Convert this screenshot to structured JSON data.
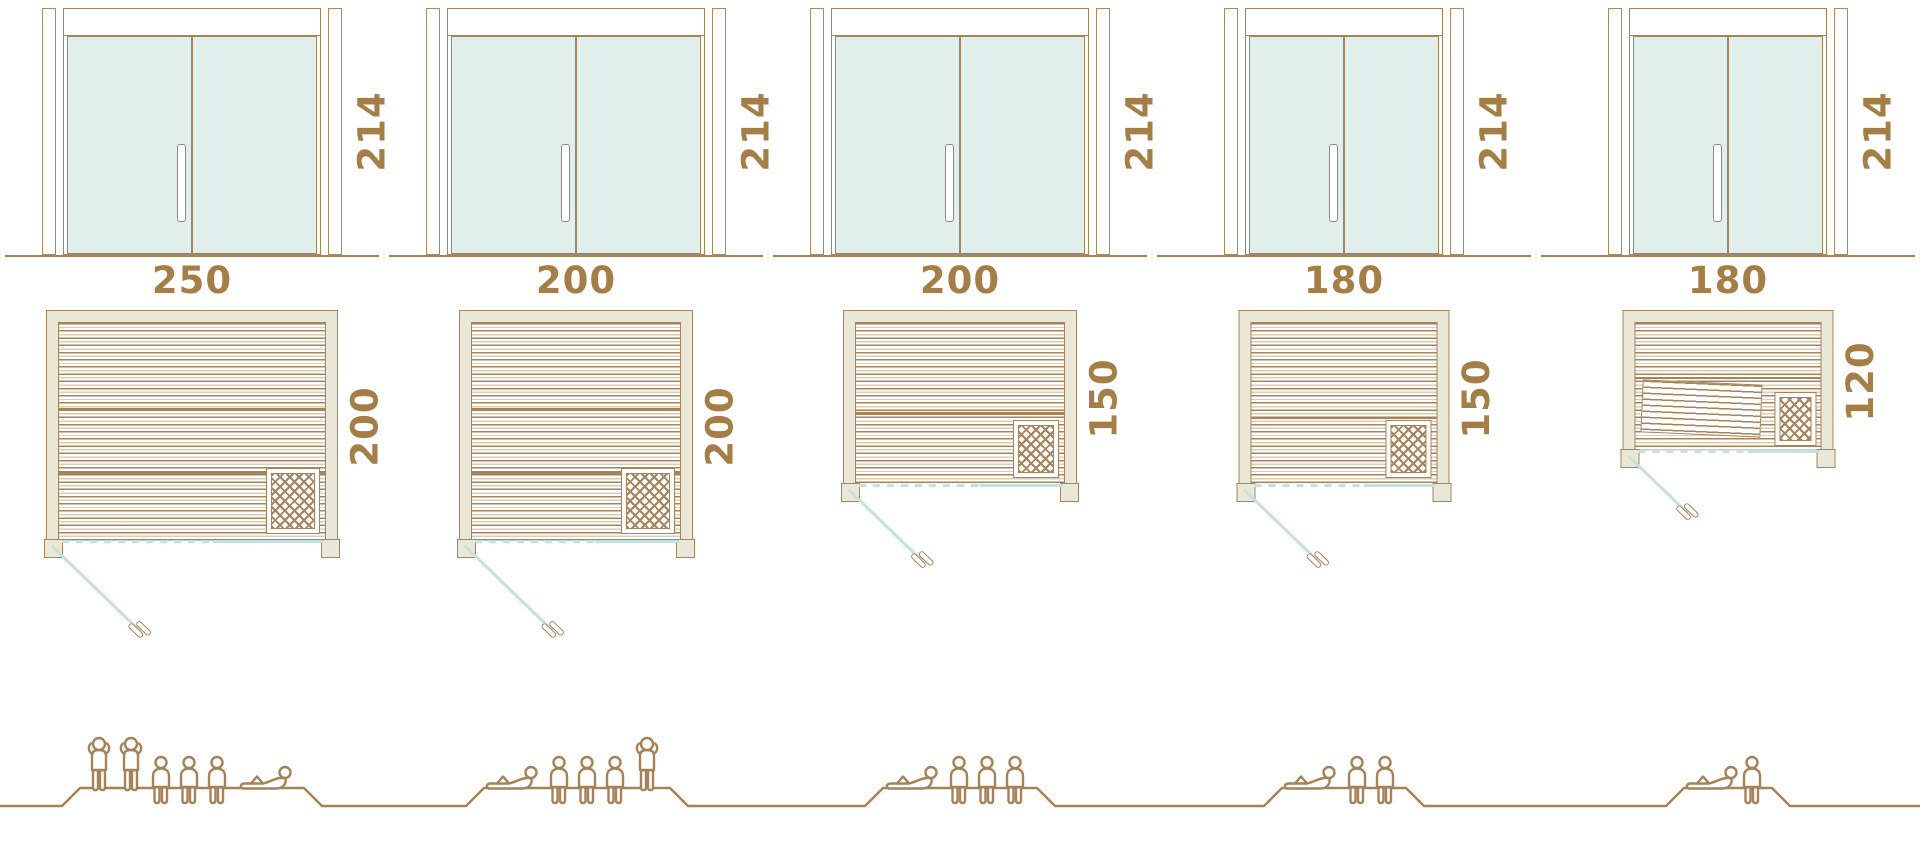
{
  "diagram_title": "sauna sizes with door elevation, floor plan and capacity figures",
  "colors": {
    "line_brown": "#a6835b",
    "figure_brown": "#a58257",
    "dimension_text": "#a57d46",
    "wall_beige": "#ebe7d6",
    "glass_mint": "#e1efec",
    "glass_front_blue": "#c6e0dc",
    "background": "#ffffff"
  },
  "icons": {
    "standing_icon": "person-standing",
    "seated_icon": "person-seated",
    "lying_icon": "person-lying",
    "heater_icon": "sauna-heater-lattice",
    "handle_icon": "door-handle"
  },
  "units": [
    {
      "door_height": "214",
      "plan_width": "250",
      "plan_depth": "200",
      "capacity": {
        "standing": 2,
        "seated": 3,
        "lying": 1,
        "total": 6,
        "figure_sequence": [
          "standing",
          "standing",
          "seated",
          "seated",
          "seated",
          "lying"
        ]
      }
    },
    {
      "door_height": "214",
      "plan_width": "200",
      "plan_depth": "200",
      "capacity": {
        "standing": 1,
        "seated": 3,
        "lying": 1,
        "total": 5,
        "figure_sequence": [
          "lying",
          "seated",
          "seated",
          "seated",
          "standing"
        ]
      }
    },
    {
      "door_height": "214",
      "plan_width": "200",
      "plan_depth": "150",
      "capacity": {
        "standing": 0,
        "seated": 3,
        "lying": 1,
        "total": 4,
        "figure_sequence": [
          "lying",
          "seated",
          "seated",
          "seated"
        ]
      }
    },
    {
      "door_height": "214",
      "plan_width": "180",
      "plan_depth": "150",
      "capacity": {
        "standing": 0,
        "seated": 2,
        "lying": 1,
        "total": 3,
        "figure_sequence": [
          "lying",
          "seated",
          "seated"
        ]
      }
    },
    {
      "door_height": "214",
      "plan_width": "180",
      "plan_depth": "120",
      "capacity": {
        "standing": 0,
        "seated": 1,
        "lying": 1,
        "total": 2,
        "figure_sequence": [
          "lying",
          "seated"
        ]
      }
    }
  ]
}
